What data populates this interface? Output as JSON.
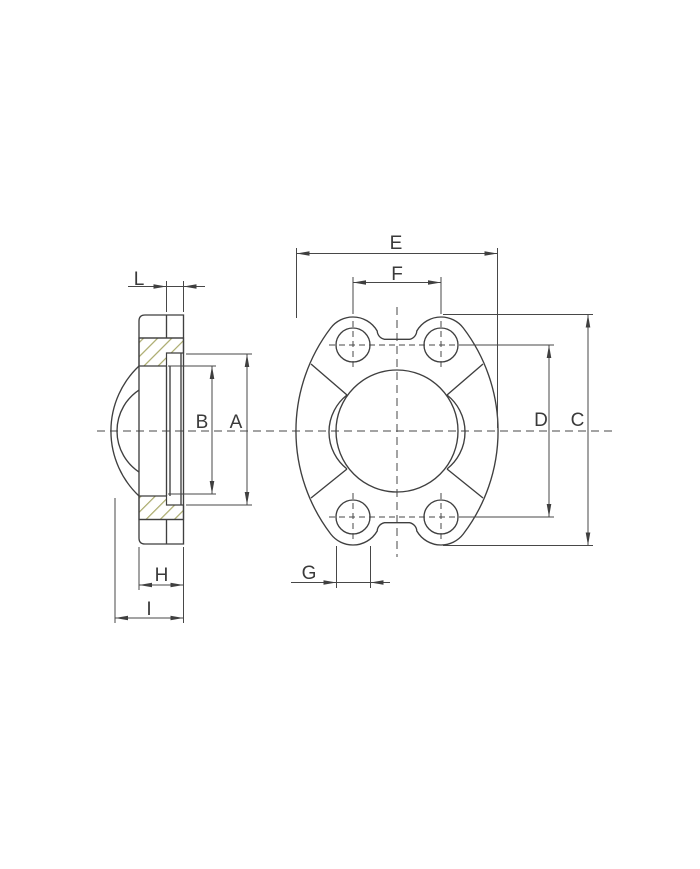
{
  "drawing": {
    "kind": "two-view flange clamp technical drawing",
    "views": {
      "side_view": "sectioned side view with hatched cut faces",
      "front_view": "front view of split flange clamp with four bolt holes"
    },
    "dimension_labels": {
      "L": "L",
      "B": "B",
      "A": "A",
      "H": "H",
      "I": "I",
      "E": "E",
      "F": "F",
      "C": "C",
      "D": "D",
      "G": "G"
    },
    "colors": {
      "line": "#3f3f3f",
      "dimension_line": "#474747",
      "text": "#3a3a3a",
      "hatch": "#a9a96a",
      "background": "#ffffff"
    }
  }
}
